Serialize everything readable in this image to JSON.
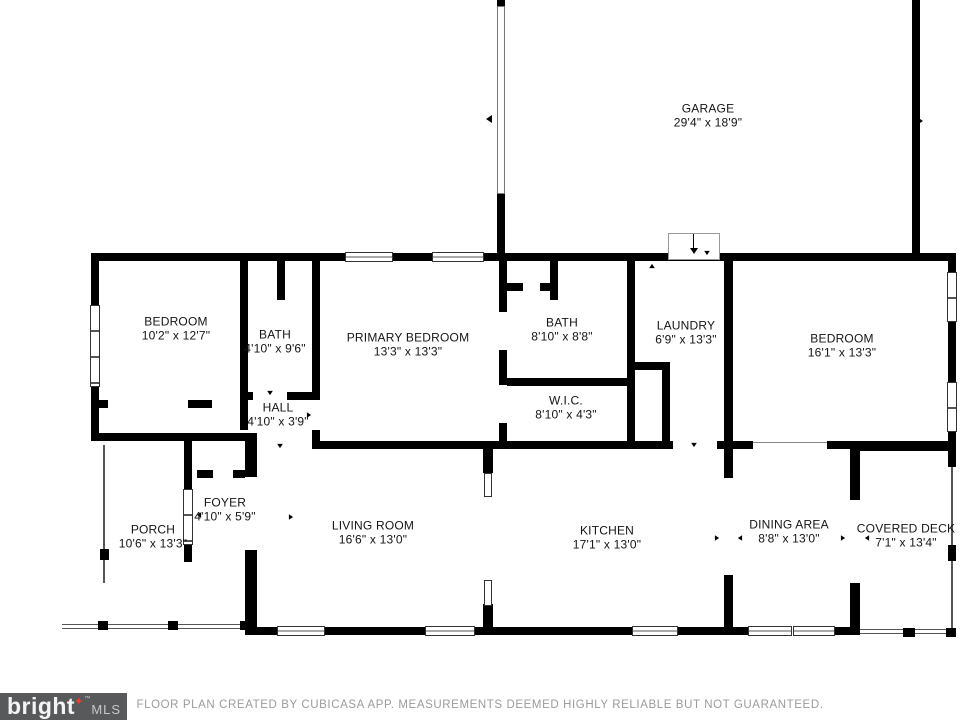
{
  "plan": {
    "rooms": [
      {
        "name": "GARAGE",
        "dims": "29'4\" x 18'9\""
      },
      {
        "name": "BEDROOM",
        "dims": "10'2\" x 12'7\""
      },
      {
        "name": "BATH",
        "dims": "4'10\" x 9'6\""
      },
      {
        "name": "PRIMARY BEDROOM",
        "dims": "13'3\" x 13'3\""
      },
      {
        "name": "BATH",
        "dims": "8'10\" x 8'8\""
      },
      {
        "name": "LAUNDRY",
        "dims": "6'9\" x 13'3\""
      },
      {
        "name": "BEDROOM",
        "dims": "16'1\" x 13'3\""
      },
      {
        "name": "HALL",
        "dims": "4'10\" x 3'9\""
      },
      {
        "name": "W.I.C.",
        "dims": "8'10\" x 4'3\""
      },
      {
        "name": "FOYER",
        "dims": "4'10\" x 5'9\""
      },
      {
        "name": "PORCH",
        "dims": "10'6\" x 13'3\""
      },
      {
        "name": "LIVING ROOM",
        "dims": "16'6\" x 13'0\""
      },
      {
        "name": "KITCHEN",
        "dims": "17'1\" x 13'0\""
      },
      {
        "name": "DINING AREA",
        "dims": "8'8\" x 13'0\""
      },
      {
        "name": "COVERED DECK",
        "dims": "7'1\" x 13'4\""
      }
    ]
  },
  "footer": {
    "text": "FLOOR PLAN CREATED BY CUBICASA APP. MEASUREMENTS DEEMED HIGHLY RELIABLE BUT NOT GUARANTEED."
  },
  "logo": {
    "brand": "bright",
    "star": "✦",
    "trademark": "™",
    "suffix": "MLS"
  },
  "colors": {
    "wall": "#000000",
    "footer_text": "#9b9b9b",
    "logo_background": "#58595b",
    "logo_star": "#ef4123"
  }
}
